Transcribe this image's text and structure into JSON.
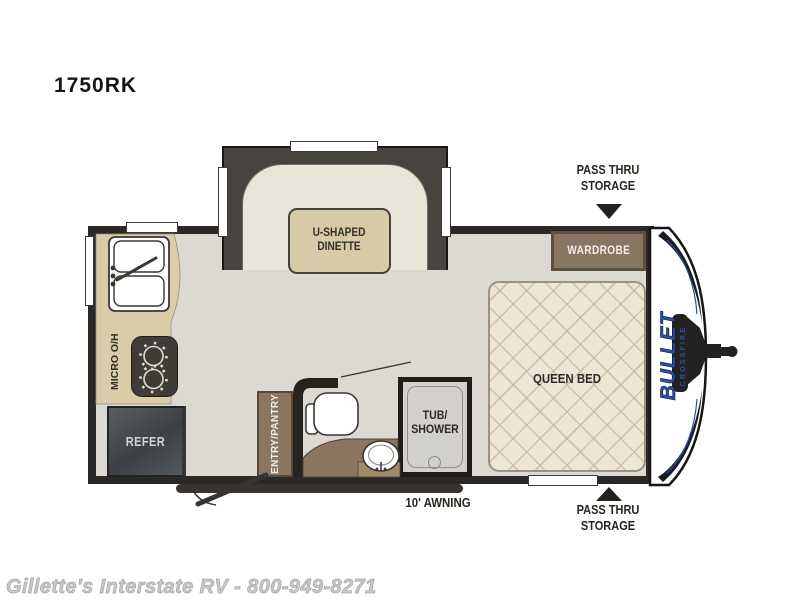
{
  "title": "1750RK",
  "floorplan": {
    "dinette": {
      "line1": "U-SHAPED",
      "line2": "DINETTE"
    },
    "wardrobe": "WARDROBE",
    "queen_bed": "QUEEN BED",
    "pass_thru_top": {
      "line1": "PASS THRU",
      "line2": "STORAGE"
    },
    "pass_thru_bottom": {
      "line1": "PASS THRU",
      "line2": "STORAGE"
    },
    "tv_prep": "TV PREP",
    "tub_shower": {
      "line1": "TUB/",
      "line2": "SHOWER"
    },
    "micro_oh": "MICRO O/H",
    "refer": "REFER",
    "entry_pantry": "ENTRY/PANTRY",
    "awning": "10' AWNING"
  },
  "branding": {
    "make": "BULLET",
    "series": "CROSSFIRE"
  },
  "footer": "Gillette's Interstate RV - 800-949-8271",
  "colors": {
    "wall": "#2b2825",
    "floor": "#dcd9d3",
    "cabinet_brown": "#8b7560",
    "counter_tan": "#d9cca9",
    "bed_cream": "#ece6d4",
    "brand_blue": "#2b4ea5"
  }
}
